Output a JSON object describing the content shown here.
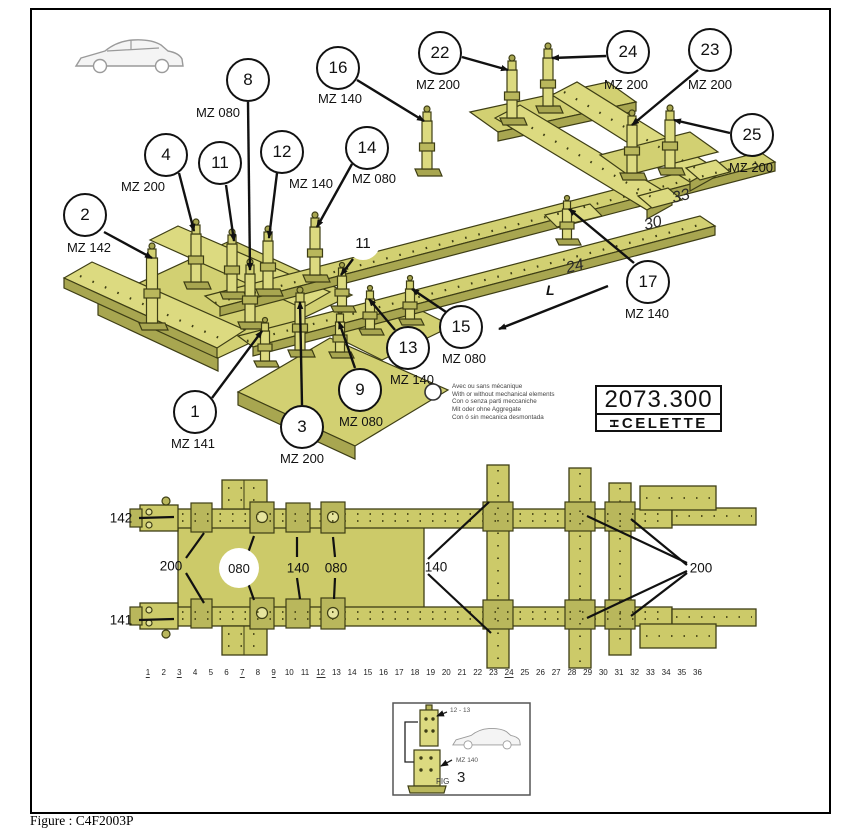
{
  "figure_caption": "Figure : C4F2003P",
  "plate": {
    "part_number": "2073.300",
    "brand": "CELETTE"
  },
  "legend": {
    "lines": [
      "Avec ou sans mécanique",
      "With or without mechanical elements",
      "Con o senza parti meccaniche",
      "Mit oder ohne Aggregate",
      "Con ó sin mecanica desmontada"
    ]
  },
  "iso_view": {
    "direction_label": "L",
    "inline_marks": [
      {
        "text": "24",
        "x": 575,
        "y": 267
      },
      {
        "text": "30",
        "x": 653,
        "y": 224
      },
      {
        "text": "33",
        "x": 681,
        "y": 197
      }
    ],
    "callouts": [
      {
        "num": "2",
        "label": "MZ 142",
        "cx": 85,
        "cy": 215,
        "lx": 89,
        "ly": 240,
        "arrow": [
          104,
          232,
          152,
          258
        ]
      },
      {
        "num": "4",
        "label": "MZ 200",
        "cx": 166,
        "cy": 155,
        "lx": 143,
        "ly": 179,
        "arrow": [
          179,
          173,
          194,
          231
        ]
      },
      {
        "num": "11",
        "label": "",
        "cx": 220,
        "cy": 163,
        "arrow": [
          226,
          185,
          234,
          241
        ]
      },
      {
        "num": "8",
        "label": "MZ 080",
        "cx": 248,
        "cy": 80,
        "lx": 218,
        "ly": 105,
        "arrow": [
          248,
          102,
          250,
          270
        ]
      },
      {
        "num": "12",
        "label": "MZ 140",
        "cx": 282,
        "cy": 152,
        "lx": 311,
        "ly": 176,
        "arrow": [
          277,
          173,
          269,
          238
        ]
      },
      {
        "num": "14",
        "label": "MZ 080",
        "cx": 367,
        "cy": 148,
        "lx": 374,
        "ly": 171,
        "arrow": [
          352,
          164,
          317,
          227
        ]
      },
      {
        "num": "16",
        "label": "MZ 140",
        "cx": 338,
        "cy": 68,
        "lx": 340,
        "ly": 91,
        "arrow": [
          357,
          80,
          424,
          121
        ]
      },
      {
        "num": "22",
        "label": "MZ 200",
        "cx": 440,
        "cy": 53,
        "lx": 438,
        "ly": 77,
        "arrow": [
          462,
          57,
          508,
          70
        ]
      },
      {
        "num": "24",
        "label": "MZ 200",
        "cx": 628,
        "cy": 52,
        "lx": 626,
        "ly": 77,
        "arrow": [
          606,
          56,
          552,
          58
        ]
      },
      {
        "num": "23",
        "label": "MZ 200",
        "cx": 710,
        "cy": 50,
        "lx": 710,
        "ly": 77,
        "arrow": [
          698,
          70,
          632,
          125
        ]
      },
      {
        "num": "25",
        "label": "MZ 200",
        "cx": 752,
        "cy": 135,
        "lx": 751,
        "ly": 160,
        "arrow": [
          730,
          133,
          674,
          120
        ]
      },
      {
        "num": "17",
        "label": "MZ 140",
        "cx": 648,
        "cy": 282,
        "lx": 647,
        "ly": 306,
        "arrow": [
          634,
          263,
          569,
          209
        ]
      },
      {
        "num": "15",
        "label": "MZ 080",
        "cx": 461,
        "cy": 327,
        "lx": 464,
        "ly": 351,
        "arrow": [
          446,
          312,
          412,
          289
        ]
      },
      {
        "num": "13",
        "label": "MZ 140",
        "cx": 408,
        "cy": 348,
        "lx": 412,
        "ly": 372,
        "arrow": [
          395,
          330,
          369,
          299
        ]
      },
      {
        "num": "9",
        "label": "MZ 080",
        "cx": 360,
        "cy": 390,
        "lx": 361,
        "ly": 414,
        "arrow": [
          355,
          368,
          339,
          322
        ]
      },
      {
        "num": "1",
        "label": "MZ 141",
        "cx": 195,
        "cy": 412,
        "lx": 193,
        "ly": 436,
        "arrow": [
          212,
          398,
          262,
          331
        ]
      },
      {
        "num": "3",
        "label": "MZ 200",
        "cx": 302,
        "cy": 427,
        "lx": 302,
        "ly": 451,
        "arrow": [
          302,
          405,
          300,
          302
        ]
      },
      {
        "num": "11",
        "label": "",
        "cx": 363,
        "cy": 243,
        "plain": true,
        "arrow": [
          353,
          259,
          341,
          275
        ]
      }
    ]
  },
  "top_view": {
    "labels": [
      {
        "text": "142",
        "x": 121,
        "y": 518,
        "leaders": [
          [
            139,
            518,
            174,
            517
          ]
        ]
      },
      {
        "text": "141",
        "x": 121,
        "y": 620,
        "leaders": [
          [
            139,
            620,
            174,
            619
          ]
        ]
      },
      {
        "text": "200",
        "x": 171,
        "y": 566,
        "leaders": [
          [
            186,
            558,
            204,
            533
          ],
          [
            186,
            573,
            204,
            603
          ]
        ]
      },
      {
        "text": "080",
        "x": 239,
        "y": 568,
        "circled": true,
        "leaders": [
          [
            248,
            553,
            254,
            536
          ],
          [
            248,
            583,
            254,
            600
          ]
        ]
      },
      {
        "text": "140",
        "x": 298,
        "y": 568,
        "leaders": [
          [
            297,
            557,
            297,
            537
          ],
          [
            297,
            578,
            300,
            599
          ]
        ]
      },
      {
        "text": "080",
        "x": 336,
        "y": 568,
        "leaders": [
          [
            335,
            557,
            333,
            537
          ],
          [
            335,
            578,
            334,
            599
          ]
        ]
      },
      {
        "text": "140",
        "x": 436,
        "y": 567,
        "leaders": [
          [
            428,
            559,
            489,
            502
          ],
          [
            428,
            574,
            491,
            633
          ]
        ]
      },
      {
        "text": "200",
        "x": 701,
        "y": 568,
        "leaders": [
          [
            687,
            563,
            587,
            516
          ],
          [
            687,
            565,
            631,
            519
          ],
          [
            687,
            571,
            587,
            618
          ],
          [
            687,
            573,
            631,
            616
          ]
        ]
      }
    ],
    "ruler": {
      "numbers": [
        "1",
        "2",
        "3",
        "4",
        "5",
        "6",
        "7",
        "8",
        "9",
        "10",
        "11",
        "12",
        "13",
        "14",
        "15",
        "16",
        "17",
        "18",
        "19",
        "20",
        "21",
        "22",
        "23",
        "24",
        "25",
        "26",
        "27",
        "28",
        "29",
        "30",
        "31",
        "32",
        "33",
        "34",
        "35",
        "36"
      ],
      "underlined": [
        "1",
        "3",
        "7",
        "9",
        "12",
        "24"
      ]
    }
  },
  "inset": {
    "ref_label": "12 - 13",
    "part_label": "MZ 140",
    "fig_label": "FIG",
    "fig_number": "3"
  }
}
